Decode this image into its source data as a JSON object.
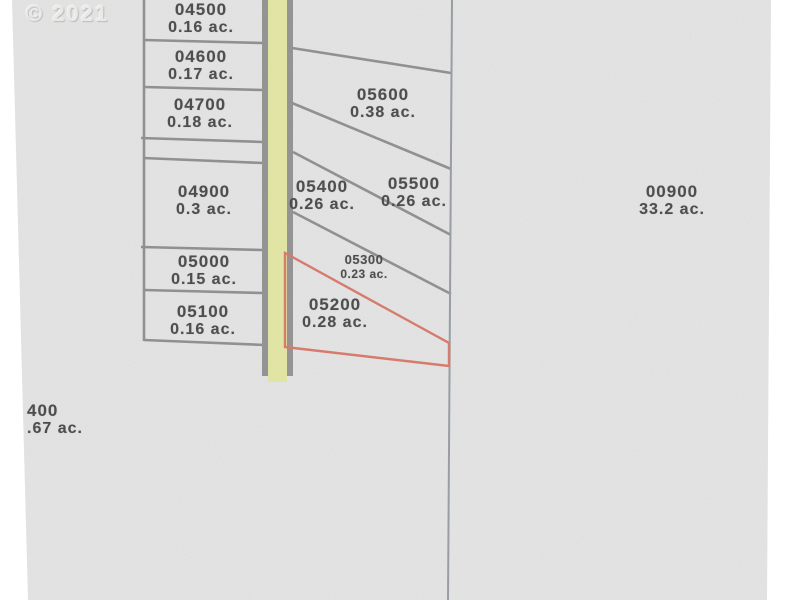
{
  "copyright": "© 2021",
  "highlighted_lot": "05200",
  "colors": {
    "paper": "#e9eae9",
    "road_yellow": "#e8eca1",
    "parcel_line_gray": "#8b8b8b",
    "section_line_gray": "#959aa1",
    "highlight_red": "#dc7262",
    "label_text": "#3d3d3d"
  },
  "parcels": [
    {
      "lot": "04500",
      "acreage": "0.16 ac."
    },
    {
      "lot": "04600",
      "acreage": "0.17 ac."
    },
    {
      "lot": "04700",
      "acreage": "0.18 ac."
    },
    {
      "lot": "04900",
      "acreage": "0.3 ac."
    },
    {
      "lot": "05000",
      "acreage": "0.15 ac."
    },
    {
      "lot": "05100",
      "acreage": "0.16 ac."
    },
    {
      "lot": "05600",
      "acreage": "0.38 ac."
    },
    {
      "lot": "05400",
      "acreage": "0.26 ac."
    },
    {
      "lot": "05500",
      "acreage": "0.26 ac."
    },
    {
      "lot": "05300",
      "acreage": "0.23 ac."
    },
    {
      "lot": "05200",
      "acreage": "0.28 ac."
    },
    {
      "lot": "00900",
      "acreage": "33.2 ac."
    },
    {
      "lot": "400",
      "acreage": ".67 ac."
    }
  ]
}
